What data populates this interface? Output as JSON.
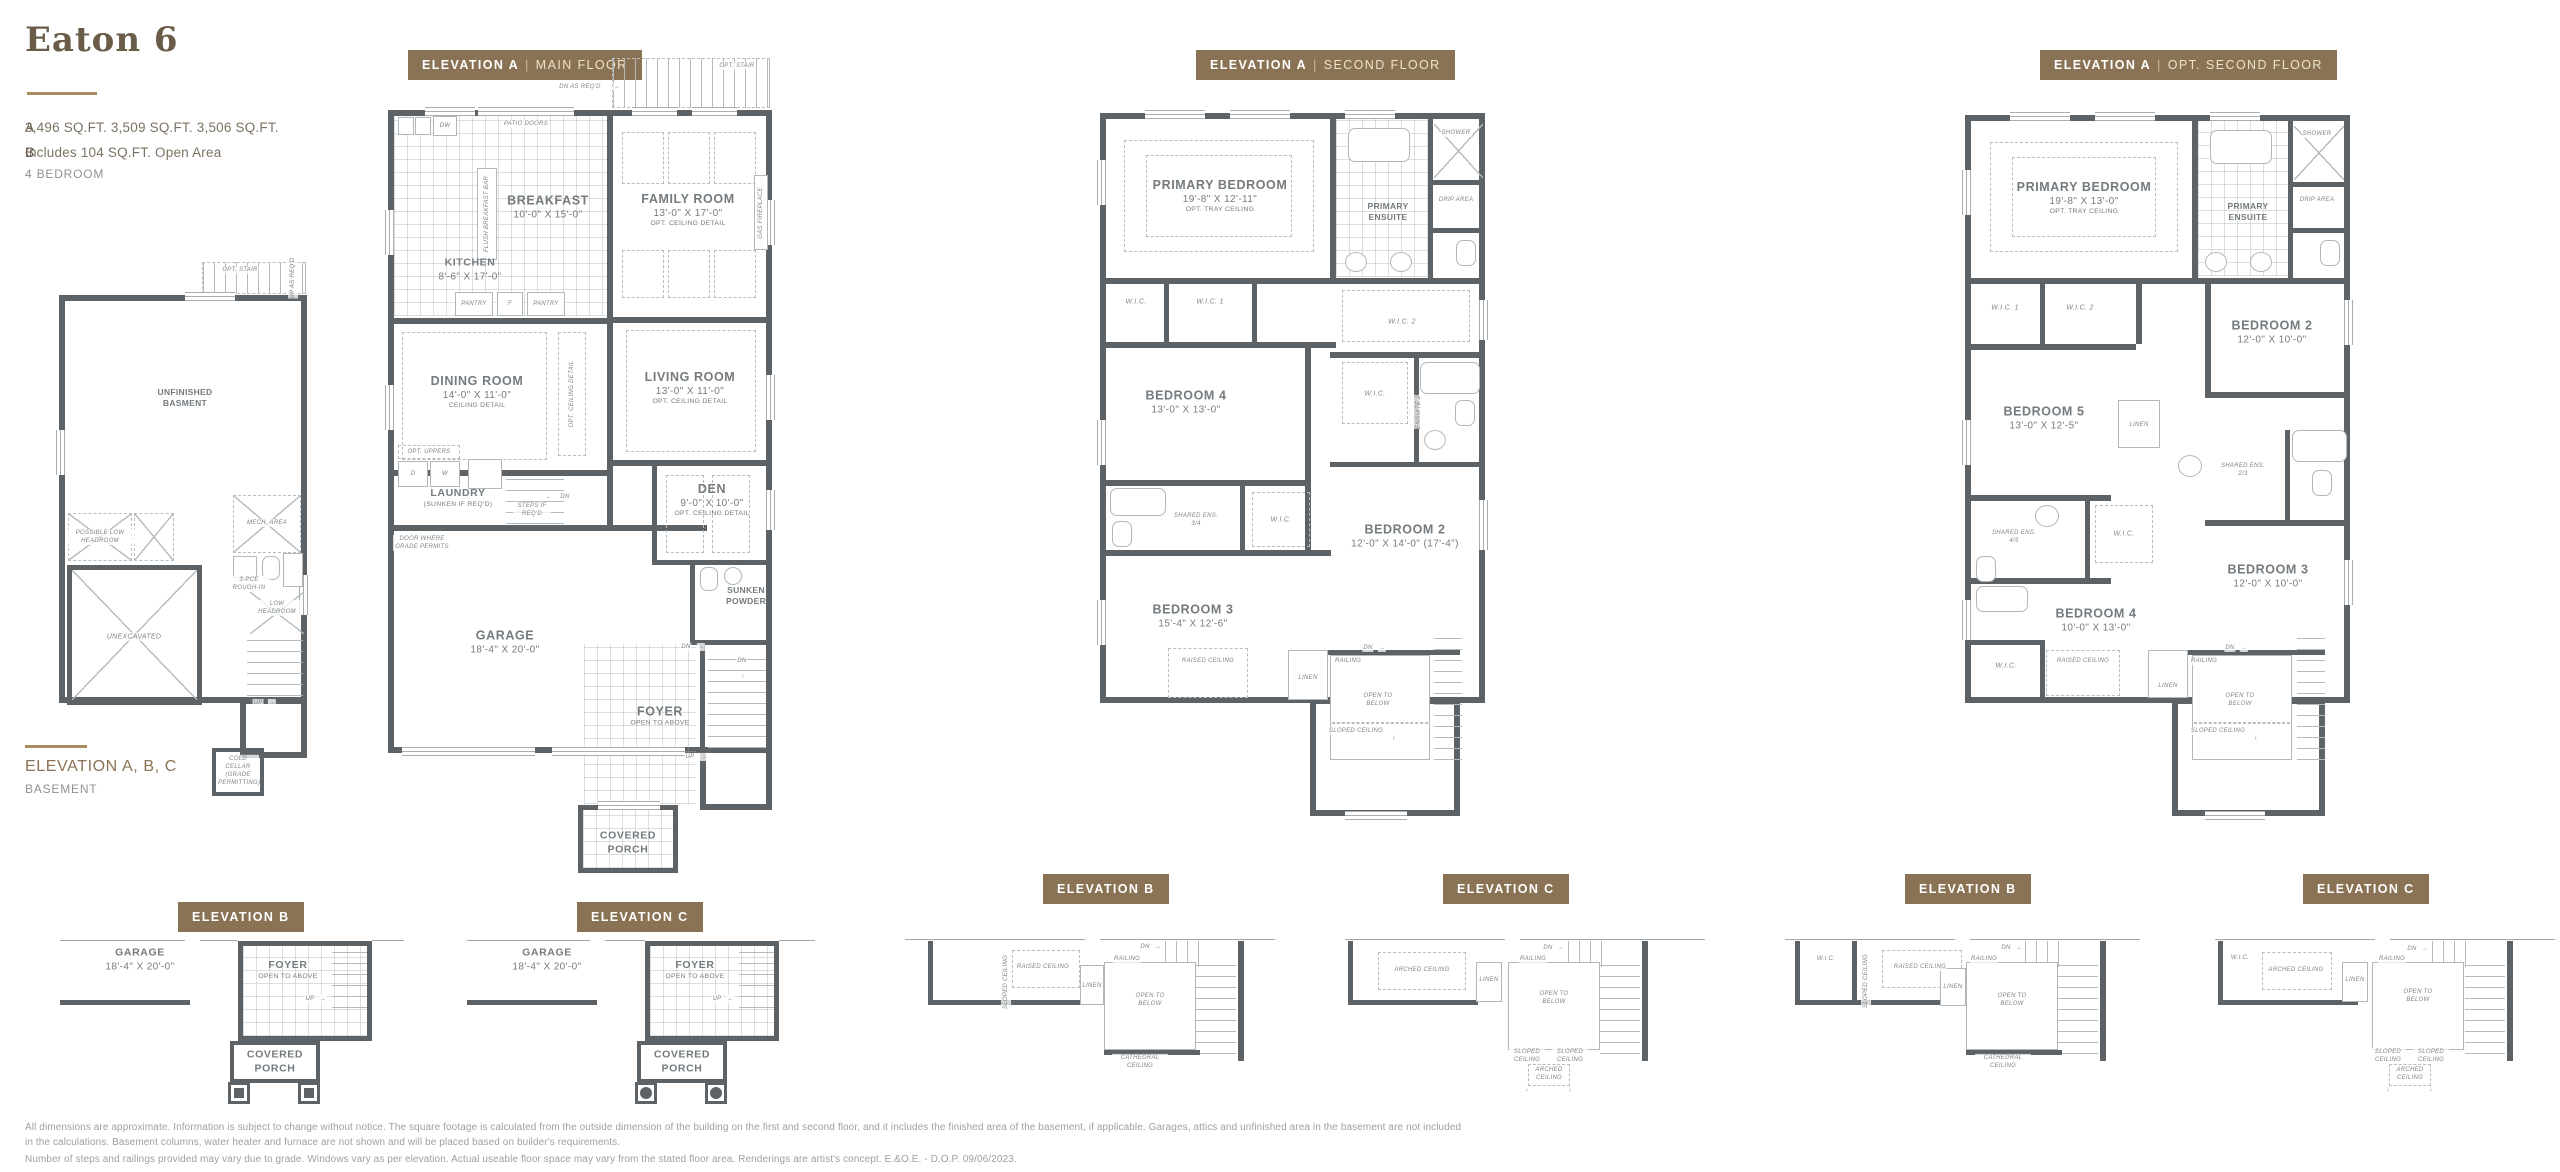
{
  "header": {
    "title": "Eaton 6",
    "spec_a_label": "A",
    "spec_a": "3,496 SQ.FT.",
    "spec_b_label": "B",
    "spec_b": "3,509 SQ.FT.",
    "spec_c_label": "C",
    "spec_c": "3,506 SQ.FT.",
    "spec_line2": "Includes 104 SQ.FT. Open Area",
    "bedrooms": "4 BEDROOM"
  },
  "colors": {
    "badge": "#8a7254",
    "accent": "#a98e5f",
    "wall": "#5d6266"
  },
  "icons": {
    "arrow_right": "→",
    "arrow_left": "←",
    "arrow_down": "↓",
    "arrow_up": "↑"
  },
  "badges": {
    "main": {
      "elev": "ELEVATION A",
      "sep": "|",
      "floor": "MAIN FLOOR"
    },
    "second": {
      "elev": "ELEVATION A",
      "sep": "|",
      "floor": "SECOND FLOOR"
    },
    "opt": {
      "elev": "ELEVATION A",
      "sep": "|",
      "floor": "OPT. SECOND FLOOR"
    },
    "b_main": "ELEVATION B",
    "c_main": "ELEVATION C",
    "b_second": "ELEVATION B",
    "c_second": "ELEVATION C",
    "b_opt": "ELEVATION B",
    "c_opt": "ELEVATION C"
  },
  "basement": {
    "caption_title": "ELEVATION A, B, C",
    "caption_sub": "BASEMENT",
    "labels": {
      "opt_stair": "OPT. STAIR",
      "up_as_reqd": "UP AS REQ'D",
      "unfinished": "UNFINISHED BASMENT",
      "possible_low": "POSSIBLE LOW HEADROOM",
      "unexcavated": "UNEXCAVATED",
      "mech_area": "MECH. AREA",
      "rough_in": "3-PCE ROUGH-IN",
      "low_headroom": "LOW HEADROOM",
      "up": "UP",
      "cold_cellar": "COLD CELLAR (GRADE PERMITTING)"
    }
  },
  "main": {
    "rooms": {
      "breakfast": {
        "name": "BREAKFAST",
        "dims": "10'-0\" X 15'-0\""
      },
      "kitchen": {
        "name": "KITCHEN",
        "dims": "8'-6\" X 17'-0\""
      },
      "family": {
        "name": "FAMILY ROOM",
        "dims": "13'-0\" X 17'-0\"",
        "note": "OPT. CEILING DETAIL"
      },
      "dining": {
        "name": "DINING ROOM",
        "dims": "14'-0\" X 11'-0\"",
        "note": "CEILING DETAIL"
      },
      "living": {
        "name": "LIVING ROOM",
        "dims": "13'-0\" X 11'-0\"",
        "note": "OPT. CEILING DETAIL"
      },
      "den": {
        "name": "DEN",
        "dims": "9'-0\" X 10'-0\"",
        "note": "OPT. CEILING DETAIL"
      },
      "laundry": {
        "name": "LAUNDRY",
        "note": "(SUNKEN IF REQ'D)"
      },
      "garage": {
        "name": "GARAGE",
        "dims": "18'-4\" X 20'-0\""
      },
      "foyer": {
        "name": "FOYER",
        "note": "OPEN TO ABOVE"
      },
      "powder": {
        "name": "SUNKEN POWDER"
      },
      "porch": {
        "name": "COVERED PORCH"
      }
    },
    "labels": {
      "opt_stair": "OPT. STAIR",
      "dn_as_reqd": "DN AS REQ'D",
      "patio_doors": "PATIO DOORS",
      "dw": "DW",
      "pantry_l": "PANTRY",
      "f": "F",
      "pantry_r": "PANTRY",
      "flush_bar": "FLUSH BREAKFAST BAR",
      "gas_fireplace": "GAS FIREPLACE",
      "opt_ceiling_detail": "OPT. CEILING DETAIL",
      "opt_uppers": "OPT. UPPERS",
      "d": "D",
      "w": "W",
      "steps_if_reqd": "STEPS IF REQ'D",
      "dn": "DN",
      "dn2": "DN",
      "dn3": "DN",
      "door_grade": "DOOR WHERE GRADE PERMITS",
      "up": "UP"
    }
  },
  "second": {
    "rooms": {
      "primary": {
        "name": "PRIMARY BEDROOM",
        "dims": "19'-8\" X 12'-11\"",
        "note": "OPT. TRAY CEILING"
      },
      "ensuite": {
        "name": "PRIMARY ENSUITE"
      },
      "bed4": {
        "name": "BEDROOM 4",
        "dims": "13'-0\" X 13'-0\""
      },
      "bed2": {
        "name": "BEDROOM 2",
        "dims": "12'-0\" X 14'-0\" (17'-4\")"
      },
      "bed3": {
        "name": "BEDROOM 3",
        "dims": "15'-4\" X 12'-6\""
      }
    },
    "labels": {
      "shower": "SHOWER",
      "drip_area": "DRIP AREA",
      "wic": "W.I.C.",
      "wic1": "W.I.C. 1",
      "wic2": "W.I.C. 2",
      "wic_mid": "W.I.C.",
      "wic_low": "W.I.C.",
      "ensuite2": "ENSUITE 2",
      "shared_ens": "SHARED ENS. 3/4",
      "raised_ceiling": "RAISED CEILING",
      "linen": "LINEN",
      "dn": "DN",
      "railing": "RAILING",
      "open_below": "OPEN TO BELOW",
      "sloped_ceiling": "SLOPED CEILING"
    }
  },
  "opt": {
    "rooms": {
      "primary": {
        "name": "PRIMARY BEDROOM",
        "dims": "19'-8\" X 13'-0\"",
        "note": "OPT. TRAY CEILING"
      },
      "ensuite": {
        "name": "PRIMARY ENSUITE"
      },
      "bed2": {
        "name": "BEDROOM 2",
        "dims": "12'-0\" X 10'-0\""
      },
      "bed5": {
        "name": "BEDROOM 5",
        "dims": "13'-0\" X 12'-5\""
      },
      "bed3": {
        "name": "BEDROOM 3",
        "dims": "12'-0\" X 10'-0\""
      },
      "bed4": {
        "name": "BEDROOM 4",
        "dims": "10'-0\" X 13'-0\""
      }
    },
    "labels": {
      "shower": "SHOWER",
      "drip_area": "DRIP AREA",
      "wic1": "W.I.C. 1",
      "wic2": "W.I.C. 2",
      "wic_mid": "W.I.C.",
      "wic_low": "W.I.C.",
      "linen_top": "LINEN",
      "shared_ens23": "SHARED ENS. 2/3",
      "shared_ens45": "SHARED ENS. 4/5",
      "raised_ceiling": "RAISED CEILING",
      "linen": "LINEN",
      "dn": "DN",
      "railing": "RAILING",
      "open_below": "OPEN TO BELOW",
      "sloped_ceiling": "SLOPED CEILING"
    }
  },
  "partials": {
    "b_main": {
      "garage": {
        "name": "GARAGE",
        "dims": "18'-4\" X 20'-0\""
      },
      "foyer": {
        "name": "FOYER",
        "note": "OPEN TO ABOVE"
      },
      "porch": {
        "name": "COVERED PORCH"
      },
      "up": "UP"
    },
    "c_main": {
      "garage": {
        "name": "GARAGE",
        "dims": "18'-4\" X 20'-0\""
      },
      "foyer": {
        "name": "FOYER",
        "note": "OPEN TO ABOVE"
      },
      "porch": {
        "name": "COVERED PORCH"
      },
      "up": "UP"
    },
    "b_second": {
      "raised": "RAISED CEILING",
      "sloped": "SLOPED CEILING",
      "linen": "LINEN",
      "dn": "DN",
      "railing": "RAILING",
      "open_below": "OPEN TO BELOW",
      "cathedral": "CATHEDRAL CEILING"
    },
    "c_second": {
      "arched": "ARCHED CEILING",
      "linen": "LINEN",
      "dn": "DN",
      "railing": "RAILING",
      "open_below": "OPEN TO BELOW",
      "sloped_l": "SLOPED CEILING",
      "sloped_r": "SLOPED CEILING",
      "arched2": "ARCHED CEILING"
    },
    "b_opt": {
      "wic": "W.I.C.",
      "sloped": "SLOPED CEILING",
      "raised": "RAISED CEILING",
      "linen": "LINEN",
      "dn": "DN",
      "railing": "RAILING",
      "open_below": "OPEN TO BELOW",
      "cathedral": "CATHEDRAL CEILING"
    },
    "c_opt": {
      "wic": "W.I.C.",
      "arched": "ARCHED CEILING",
      "linen": "LINEN",
      "dn": "DN",
      "railing": "RAILING",
      "open_below": "OPEN TO BELOW",
      "sloped_l": "SLOPED CEILING",
      "sloped_r": "SLOPED CEILING",
      "arched2": "ARCHED CEILING"
    }
  },
  "footer": {
    "p1": "All dimensions are approximate. Information is subject to change without notice. The square footage is calculated from the outside dimension of the building on the first and second floor, and it includes the finished area of the basement, if applicable. Garages, attics and unfinished area in the basement are not included in the calculations. Basement columns, water heater and furnace are not shown and will be placed based on builder's requirements.",
    "p2": "Number of steps and railings provided may vary due to grade. Windows vary as per elevation. Actual useable floor space may vary from the stated floor area. Renderings are artist's concept. E.&O.E. - D.O.P. 09/06/2023."
  }
}
